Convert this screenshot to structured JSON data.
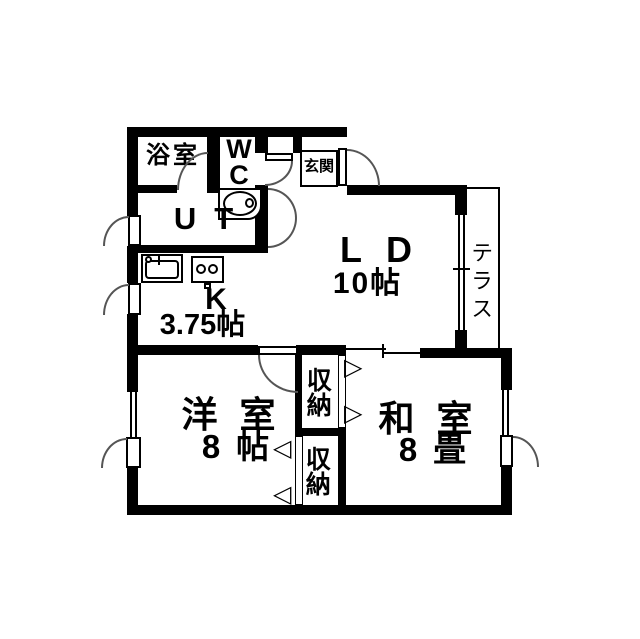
{
  "plan_title": "apartment-floor-plan",
  "rooms": {
    "bathroom": {
      "name": "浴室"
    },
    "wc": {
      "name": "WC"
    },
    "entrance": {
      "name": "玄関"
    },
    "utility": {
      "name": "UT"
    },
    "kitchen": {
      "name": "K",
      "area": "3.75帖"
    },
    "living_dining": {
      "name": "LD",
      "area": "10帖"
    },
    "terrace": {
      "name": "テラス"
    },
    "western_room": {
      "name": "洋室",
      "area": "8帖"
    },
    "japanese_room": {
      "name": "和室",
      "area": "8畳"
    },
    "closet_upper": {
      "name": "収納"
    },
    "closet_lower": {
      "name": "収納"
    }
  },
  "icons": {
    "folding_door_right": "▷",
    "folding_door_left": "◁"
  },
  "colors": {
    "wall": "#000000",
    "background": "#ffffff"
  }
}
